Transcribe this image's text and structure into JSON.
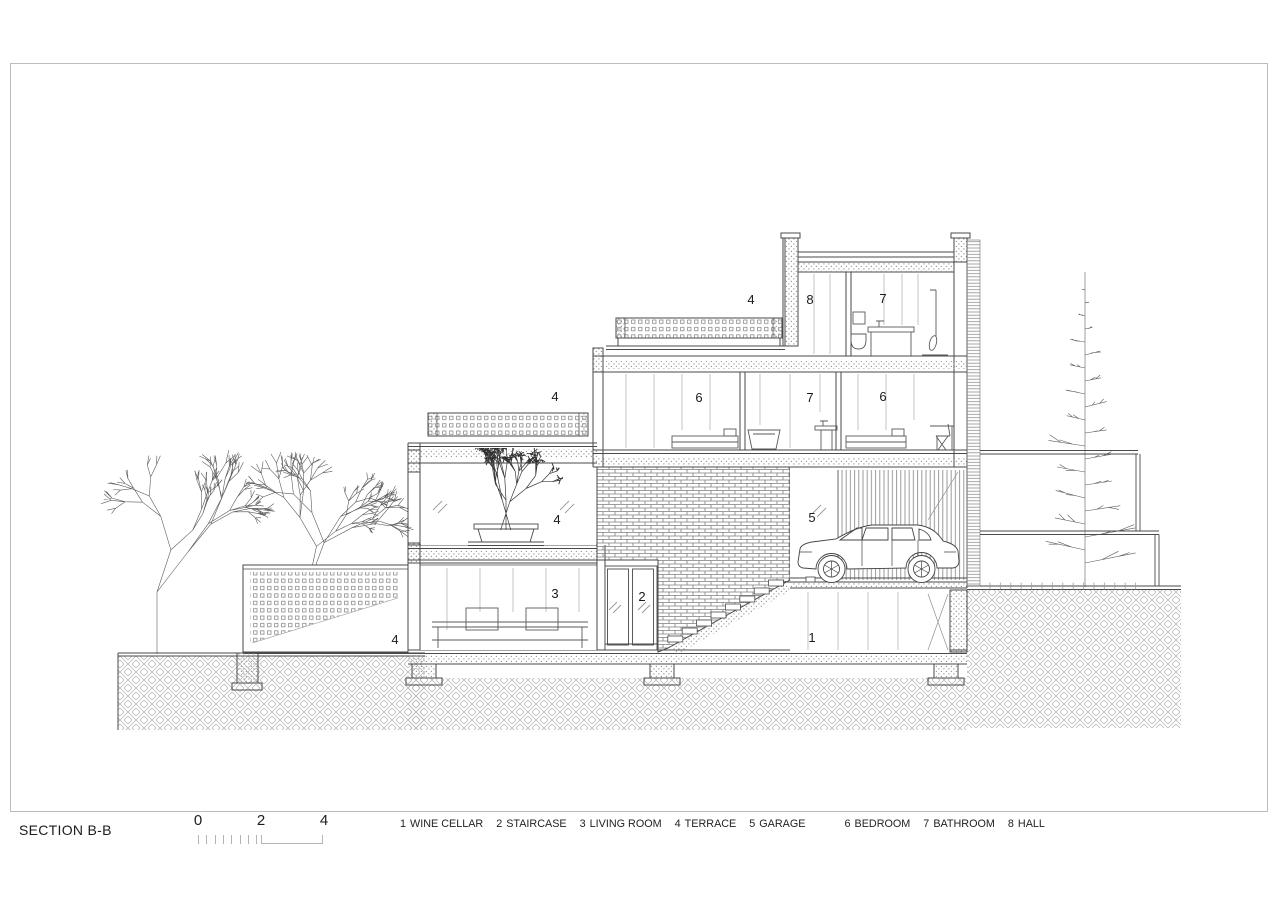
{
  "page": {
    "background": "#ffffff",
    "frame_color": "#bcbcbc",
    "line_color": "#4a4a4a",
    "hatch_color": "#9a9a9a"
  },
  "title_block": {
    "title": "SECTION B-B"
  },
  "scale_bar": {
    "labels": [
      "0",
      "2",
      "4"
    ]
  },
  "legend": {
    "items": [
      {
        "number": "1",
        "label": "WINE CELLAR"
      },
      {
        "number": "2",
        "label": "STAIRCASE"
      },
      {
        "number": "3",
        "label": "LIVING ROOM"
      },
      {
        "number": "4",
        "label": "TERRACE"
      },
      {
        "number": "5",
        "label": "GARAGE"
      },
      {
        "number": "6",
        "label": "BEDROOM"
      },
      {
        "number": "7",
        "label": "BATHROOM"
      },
      {
        "number": "8",
        "label": "HALL"
      }
    ]
  },
  "drawing": {
    "type": "architectural-section",
    "room_labels": [
      {
        "number": "4",
        "name": "terrace-roof",
        "x": 751,
        "y": 304
      },
      {
        "number": "8",
        "name": "hall",
        "x": 810,
        "y": 304
      },
      {
        "number": "7",
        "name": "bathroom-upper",
        "x": 883,
        "y": 303
      },
      {
        "number": "4",
        "name": "terrace-mid",
        "x": 555,
        "y": 401
      },
      {
        "number": "6",
        "name": "bedroom-left",
        "x": 699,
        "y": 402
      },
      {
        "number": "7",
        "name": "bathroom-mid",
        "x": 810,
        "y": 402
      },
      {
        "number": "6",
        "name": "bedroom-right",
        "x": 883,
        "y": 401
      },
      {
        "number": "4",
        "name": "terrace-garden",
        "x": 557,
        "y": 524
      },
      {
        "number": "5",
        "name": "garage",
        "x": 812,
        "y": 522
      },
      {
        "number": "3",
        "name": "living-room",
        "x": 555,
        "y": 598
      },
      {
        "number": "2",
        "name": "staircase",
        "x": 642,
        "y": 601
      },
      {
        "number": "1",
        "name": "wine-cellar",
        "x": 812,
        "y": 642
      },
      {
        "number": "4",
        "name": "terrace-front",
        "x": 395,
        "y": 644
      }
    ]
  }
}
